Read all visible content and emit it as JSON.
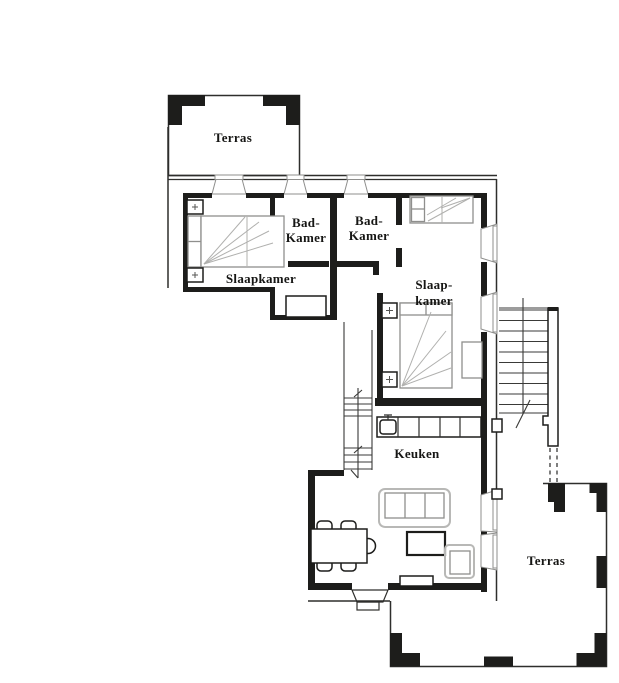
{
  "floor_plan": {
    "type": "apartment-floor-plan",
    "language": "Dutch",
    "rooms": {
      "terrace_top": {
        "label": "Terras"
      },
      "bedroom_left": {
        "label": "Slaapkamer"
      },
      "bathroom_left": {
        "line1": "Bad-",
        "line2": "Kamer"
      },
      "bathroom_right": {
        "line1": "Bad-",
        "line2": "Kamer"
      },
      "bedroom_right": {
        "line1": "Slaap-",
        "line2": "kamer"
      },
      "kitchen": {
        "label": "Keuken"
      },
      "terrace_bottom": {
        "label": "Terras"
      }
    },
    "colors": {
      "walls": "#1d1d1b",
      "thin_lines": "#2e2e2c",
      "furniture_gray": "#8f8f8d",
      "background": "#ffffff"
    }
  }
}
